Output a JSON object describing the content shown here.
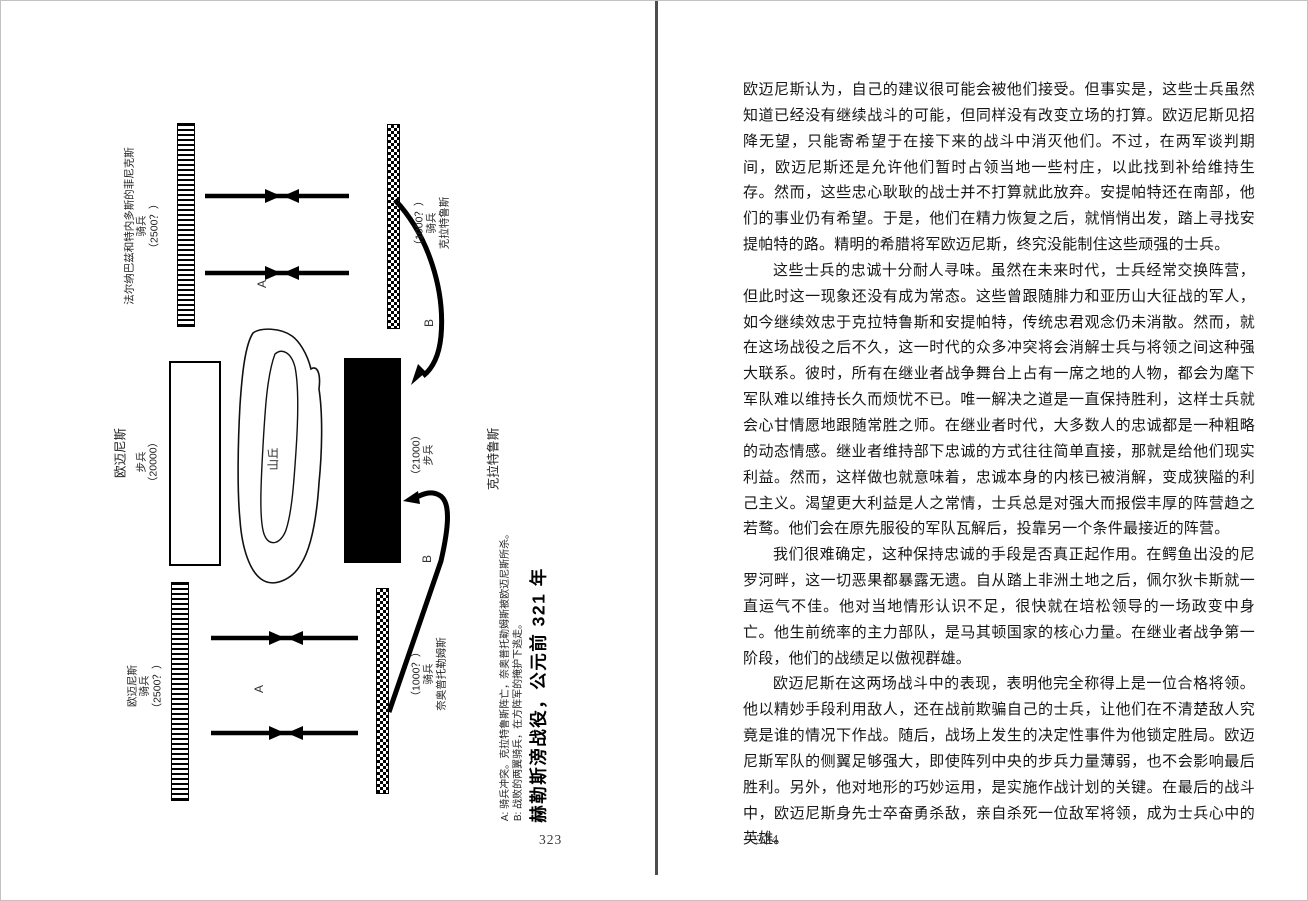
{
  "left_page": {
    "page_number": "323",
    "diagram": {
      "title": "赫勒斯滂战役，公元前 321 年",
      "notes": [
        "A: 骑兵冲突。克拉特鲁斯阵亡，奈奥普托勒姆斯被欧迈尼斯所杀。",
        "B: 战败的两翼骑兵，在方阵军的掩护下逃走。"
      ],
      "labels": {
        "pharnabazus": [
          "法尔纳巴兹和特内多斯的菲尼克斯",
          "骑兵",
          "（2500？）"
        ],
        "craterus_cavalry": [
          "（1000？）",
          "骑兵",
          "克拉特鲁斯"
        ],
        "eumenes_name": "欧迈尼斯",
        "eumenes_infantry": [
          "步兵",
          "（20000）"
        ],
        "hill": "山丘",
        "craterus_infantry": [
          "（21000）",
          "步兵"
        ],
        "craterus_name": "克拉特鲁斯",
        "eumenes_cavalry": [
          "欧迈尼斯",
          "骑兵",
          "（2500？）"
        ],
        "neoptolemus": [
          "（1000？）",
          "骑兵",
          "奈奥普托勒姆斯"
        ]
      },
      "markers": {
        "a": "A",
        "b": "B"
      }
    }
  },
  "right_page": {
    "page_number": "324",
    "paragraphs": [
      "欧迈尼斯认为，自己的建议很可能会被他们接受。但事实是，这些士兵虽然知道已经没有继续战斗的可能，但同样没有改变立场的打算。欧迈尼斯见招降无望，只能寄希望于在接下来的战斗中消灭他们。不过，在两军谈判期间，欧迈尼斯还是允许他们暂时占领当地一些村庄，以此找到补给维持生存。然而，这些忠心耿耿的战士并不打算就此放弃。安提帕特还在南部，他们的事业仍有希望。于是，他们在精力恢复之后，就悄悄出发，踏上寻找安提帕特的路。精明的希腊将军欧迈尼斯，终究没能制住这些顽强的士兵。",
      "这些士兵的忠诚十分耐人寻味。虽然在未来时代，士兵经常交换阵营，但此时这一现象还没有成为常态。这些曾跟随腓力和亚历山大征战的军人，如今继续效忠于克拉特鲁斯和安提帕特，传统忠君观念仍未消散。然而，就在这场战役之后不久，这一时代的众多冲突将会消解士兵与将领之间这种强大联系。彼时，所有在继业者战争舞台上占有一席之地的人物，都会为麾下军队难以维持长久而烦忧不已。唯一解决之道是一直保持胜利，这样士兵就会心甘情愿地跟随常胜之师。在继业者时代，大多数人的忠诚都是一种粗略的动态情感。继业者维持部下忠诚的方式往往简单直接，那就是给他们现实利益。然而，这样做也就意味着，忠诚本身的内核已被消解，变成狭隘的利己主义。渴望更大利益是人之常情，士兵总是对强大而报偿丰厚的阵营趋之若鹜。他们会在原先服役的军队瓦解后，投靠另一个条件最接近的阵营。",
      "我们很难确定，这种保持忠诚的手段是否真正起作用。在鳄鱼出没的尼罗河畔，这一切恶果都暴露无遗。自从踏上非洲土地之后，佩尔狄卡斯就一直运气不佳。他对当地情形认识不足，很快就在培松领导的一场政变中身亡。他生前统率的主力部队，是马其顿国家的核心力量。在继业者战争第一阶段，他们的战绩足以傲视群雄。",
      "欧迈尼斯在这两场战斗中的表现，表明他完全称得上是一位合格将领。他以精妙手段利用敌人，还在战前欺骗自己的士兵，让他们在不清楚敌人究竟是谁的情况下作战。随后，战场上发生的决定性事件为他锁定胜局。欧迈尼斯军队的侧翼足够强大，即使阵列中央的步兵力量薄弱，也不会影响最后胜利。另外，他对地形的巧妙运用，是实施作战计划的关键。在最后的战斗中，欧迈尼斯身先士卒奋勇杀敌，亲自杀死一位敌军将领，成为士兵心中的英雄。"
    ]
  }
}
